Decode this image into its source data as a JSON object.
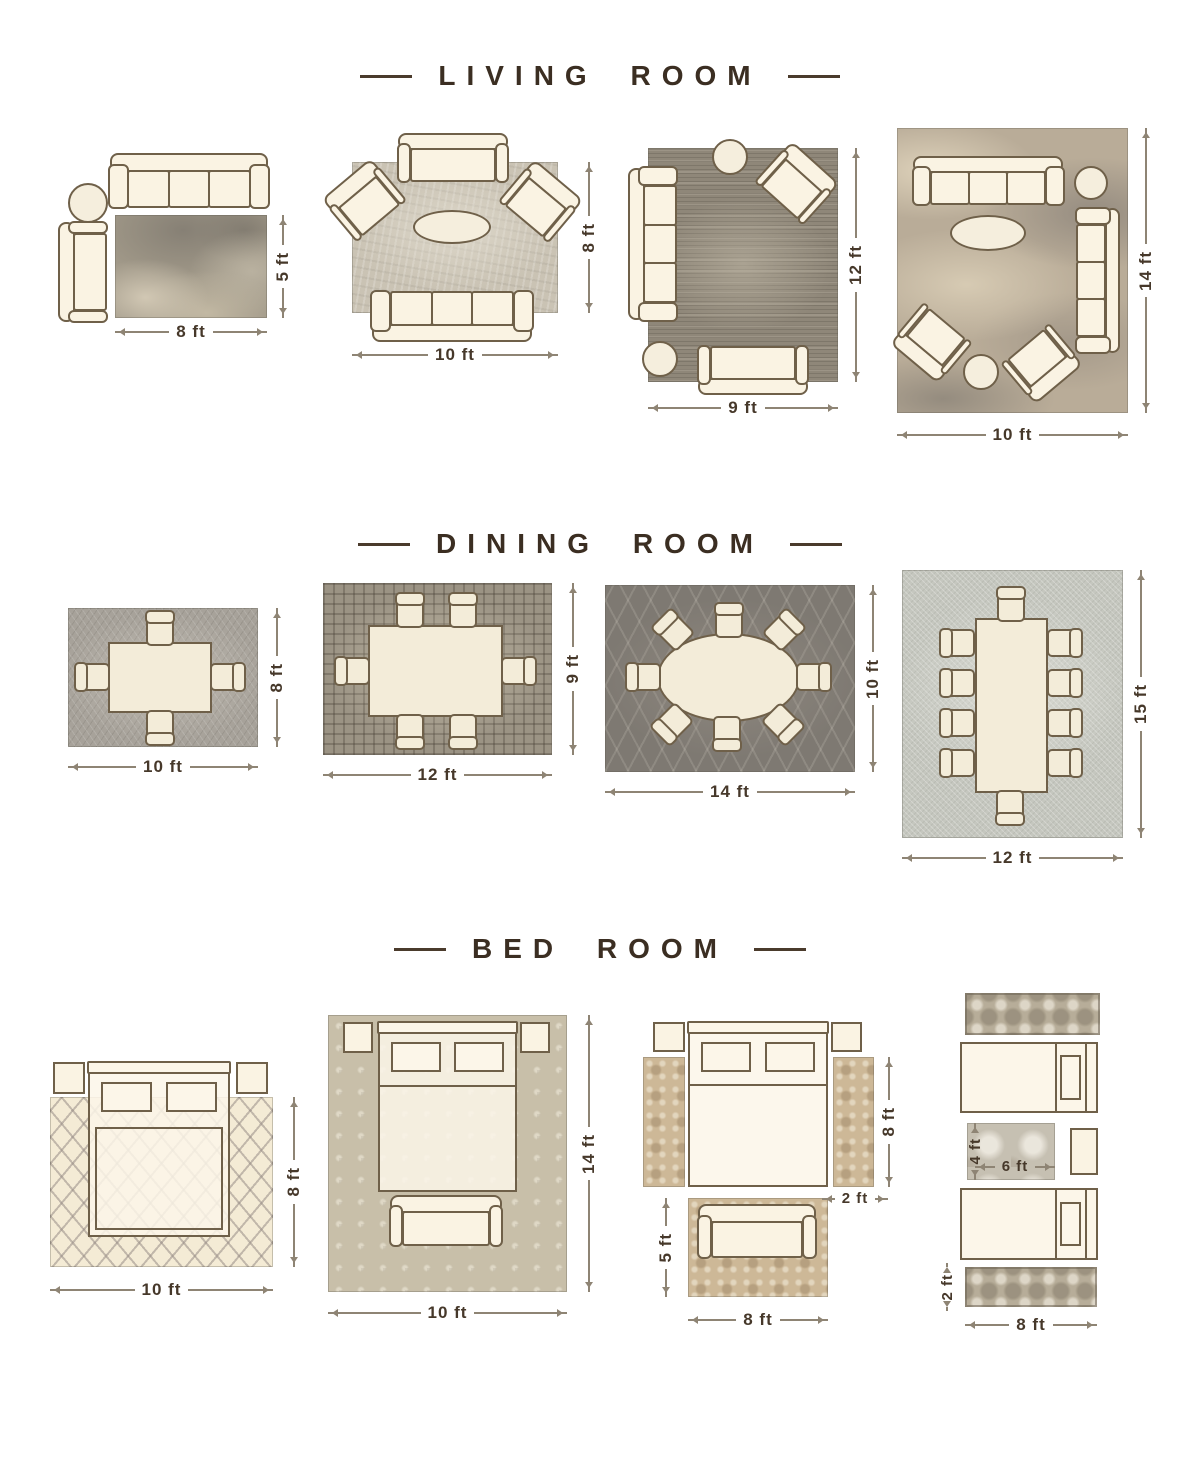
{
  "sections": {
    "living": {
      "title": "LIVING ROOM",
      "l1": {
        "w": "8 ft",
        "h": "5 ft"
      },
      "l2": {
        "w": "10 ft",
        "h": "8 ft"
      },
      "l3": {
        "w": "9 ft",
        "h": "12 ft"
      },
      "l4": {
        "w": "10 ft",
        "h": "14 ft"
      }
    },
    "dining": {
      "title": "DINING ROOM",
      "d1": {
        "w": "10 ft",
        "h": "8 ft"
      },
      "d2": {
        "w": "12 ft",
        "h": "9 ft"
      },
      "d3": {
        "w": "14 ft",
        "h": "10 ft"
      },
      "d4": {
        "w": "12 ft",
        "h": "15 ft"
      }
    },
    "bedroom": {
      "title": "BED ROOM",
      "b1": {
        "w": "10 ft",
        "h": "8 ft"
      },
      "b2": {
        "w": "10 ft",
        "h": "14 ft"
      },
      "b3": {
        "bed_side": "8 ft",
        "runner_w": "2 ft",
        "rug_h": "5 ft",
        "rug_w": "8 ft"
      },
      "b4": {
        "mid_h": "4 ft",
        "mid_w": "6 ft",
        "runner_h": "2 ft",
        "runner_w": "8 ft"
      }
    }
  },
  "colors": {
    "heading": "#3b2e22",
    "dimension_text": "#46382a",
    "furniture_outline": "#6f6049",
    "furniture_fill": "#faf3e3"
  }
}
